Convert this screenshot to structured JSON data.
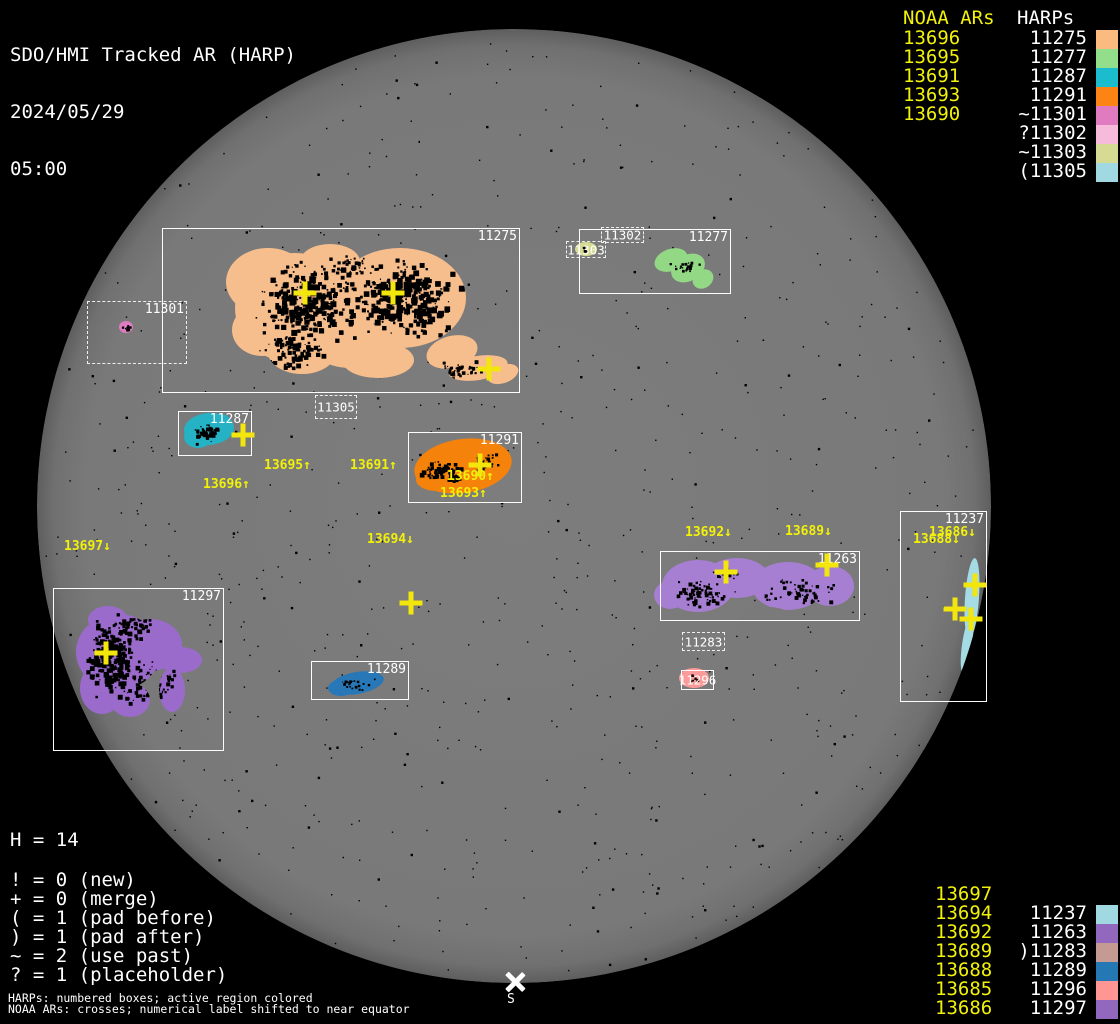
{
  "header": {
    "title": "SDO/HMI Tracked AR (HARP)",
    "date": "2024/05/29",
    "time": "05:00"
  },
  "chart_data": {
    "type": "scatter",
    "title": "SDO/HMI Tracked AR (HARP)",
    "timestamp": "2024/05/29 05:00",
    "disk": {
      "cx": 514,
      "cy": 506,
      "r": 477,
      "fill": "#7C7C7C",
      "edge": "#5E5E5E"
    },
    "harp_regions": [
      {
        "harp": "11275",
        "x": 162,
        "y": 228,
        "w": 356,
        "h": 163,
        "style": "solid",
        "label_pos": "tr",
        "color": "#F7BE8D"
      },
      {
        "harp": "11301",
        "x": 87,
        "y": 301,
        "w": 98,
        "h": 61,
        "style": "dashed",
        "label_pos": "tr",
        "color": "#DF7CC1"
      },
      {
        "harp": "11305",
        "x": 315,
        "y": 395,
        "w": 40,
        "h": 22,
        "style": "dashed",
        "label_pos": "center",
        "color": null
      },
      {
        "harp": "11287",
        "x": 178,
        "y": 411,
        "w": 72,
        "h": 43,
        "style": "solid",
        "label_pos": "tr",
        "color": "#25B2C4"
      },
      {
        "harp": "11291",
        "x": 408,
        "y": 432,
        "w": 112,
        "h": 69,
        "style": "solid",
        "label_pos": "tr",
        "color": "#F5820B"
      },
      {
        "harp": "11277",
        "x": 579,
        "y": 229,
        "w": 150,
        "h": 63,
        "style": "solid",
        "label_pos": "tr",
        "color": "#92D885"
      },
      {
        "harp": "11302",
        "x": 601,
        "y": 227,
        "w": 41,
        "h": 14,
        "style": "dashed",
        "label_pos": "center",
        "color": null
      },
      {
        "harp": "11303",
        "x": 566,
        "y": 241,
        "w": 38,
        "h": 15,
        "style": "dashed",
        "label_pos": "center",
        "color": "#D6DB94"
      },
      {
        "harp": "11297",
        "x": 53,
        "y": 588,
        "w": 169,
        "h": 161,
        "style": "solid",
        "label_pos": "tr",
        "color": "#9A6BCB"
      },
      {
        "harp": "11289",
        "x": 311,
        "y": 661,
        "w": 96,
        "h": 37,
        "style": "solid",
        "label_pos": "tr",
        "color": "#2878B8"
      },
      {
        "harp": "11263",
        "x": 660,
        "y": 551,
        "w": 198,
        "h": 68,
        "style": "solid",
        "label_pos": "tr",
        "color": "#A77FD2"
      },
      {
        "harp": "11283",
        "x": 682,
        "y": 632,
        "w": 41,
        "h": 17,
        "style": "dashed",
        "label_pos": "center",
        "color": null
      },
      {
        "harp": "11296",
        "x": 681,
        "y": 670,
        "w": 31,
        "h": 18,
        "style": "solid",
        "label_pos": "center",
        "color": "#FB9B99"
      },
      {
        "harp": "11237",
        "x": 900,
        "y": 511,
        "w": 85,
        "h": 189,
        "style": "solid",
        "label_pos": "tr",
        "color": "#A5DBE5"
      }
    ],
    "noaa_labels": [
      {
        "text": "13695↑",
        "x": 264,
        "y": 459
      },
      {
        "text": "13691↑",
        "x": 350,
        "y": 459
      },
      {
        "text": "13696↑",
        "x": 203,
        "y": 478
      },
      {
        "text": "13690↑",
        "x": 447,
        "y": 470
      },
      {
        "text": "13693↑",
        "x": 440,
        "y": 487
      },
      {
        "text": "13697↓",
        "x": 64,
        "y": 540
      },
      {
        "text": "13694↓",
        "x": 367,
        "y": 533
      },
      {
        "text": "13692↓",
        "x": 685,
        "y": 526
      },
      {
        "text": "13689↓",
        "x": 785,
        "y": 525
      },
      {
        "text": "13686↓",
        "x": 929,
        "y": 526
      },
      {
        "text": "13688↓",
        "x": 913,
        "y": 533
      }
    ],
    "noaa_crosses": [
      {
        "x": 305,
        "y": 293
      },
      {
        "x": 393,
        "y": 293
      },
      {
        "x": 489,
        "y": 369
      },
      {
        "x": 243,
        "y": 435
      },
      {
        "x": 480,
        "y": 465
      },
      {
        "x": 106,
        "y": 653
      },
      {
        "x": 411,
        "y": 603
      },
      {
        "x": 726,
        "y": 572
      },
      {
        "x": 827,
        "y": 565
      },
      {
        "x": 975,
        "y": 585
      },
      {
        "x": 955,
        "y": 609
      },
      {
        "x": 971,
        "y": 619
      }
    ],
    "south_marker": {
      "label": "S",
      "x": 515,
      "y": 982,
      "label_x": 507,
      "label_y": 992
    }
  },
  "legend_top_right": {
    "noaa_header": "NOAA ARs",
    "harp_header": "HARPs",
    "noaa_color": "#F1F10A",
    "rows": [
      {
        "noaa": "13696",
        "harp": "11275",
        "color": "#FBBB80"
      },
      {
        "noaa": "13695",
        "harp": "11277",
        "color": "#92DE8B"
      },
      {
        "noaa": "13691",
        "harp": "11287",
        "color": "#1ABCCD"
      },
      {
        "noaa": "13693",
        "harp": "11291",
        "color": "#FC8414"
      },
      {
        "noaa": "13690",
        "harp": "~11301",
        "color": "#E07BC0"
      },
      {
        "noaa": "",
        "harp": "?11302",
        "color": "#F6BADB"
      },
      {
        "noaa": "",
        "harp": "~11303",
        "color": "#D6DB94"
      },
      {
        "noaa": "",
        "harp": "(11305",
        "color": "#A0D9E2"
      }
    ]
  },
  "legend_bottom_right": {
    "rows": [
      {
        "noaa": "13697",
        "harp": "",
        "color": null
      },
      {
        "noaa": "13694",
        "harp": "11237",
        "color": "#A0D9E2"
      },
      {
        "noaa": "13692",
        "harp": "11263",
        "color": "#9168BE"
      },
      {
        "noaa": "13689",
        "harp": ")11283",
        "color": "#C49A92"
      },
      {
        "noaa": "13688",
        "harp": "11289",
        "color": "#2478B4"
      },
      {
        "noaa": "13685",
        "harp": "11296",
        "color": "#FF9694"
      },
      {
        "noaa": "13686",
        "harp": "11297",
        "color": "#9168BE"
      }
    ]
  },
  "stats": {
    "h_line": "H = 14",
    "legend_lines": [
      "! = 0 (new)",
      "+ = 0 (merge)",
      "( = 1 (pad before)",
      ") = 1 (pad after)",
      "~ = 2 (use past)",
      "? = 1 (placeholder)"
    ]
  },
  "footnotes": [
    "HARPs: numbered boxes; active region colored",
    "NOAA ARs: crosses; numerical label shifted to near equator"
  ]
}
